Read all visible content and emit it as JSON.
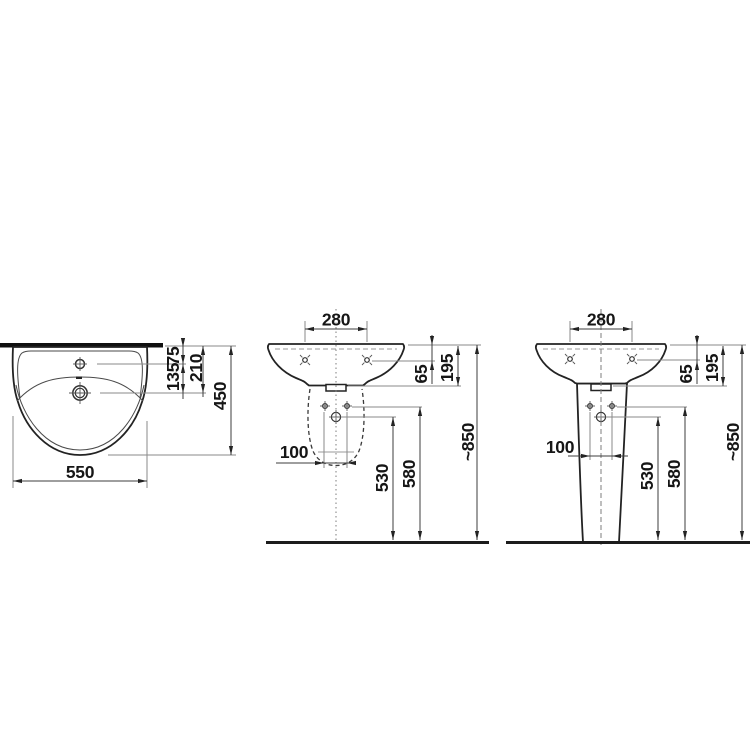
{
  "title": "Washbasin technical dimensional drawing",
  "colors": {
    "background": "#ffffff",
    "outline": "#232323",
    "dimension_line": "#3d3d3d",
    "leader_line": "#8a8a8a",
    "label_text": "#161616"
  },
  "views": {
    "top": {
      "label": "washbasin top view",
      "dims": {
        "width": "550",
        "depth": "450",
        "drain_to_wall": "210",
        "tap_to_drain": "135",
        "tap_to_wall": "75"
      }
    },
    "front_semi": {
      "label": "front view with semi-pedestal (hidden outline)",
      "dims": {
        "hole_spacing": "280",
        "rim_to_holes": "65",
        "rim_to_underside": "195",
        "pedestal_hole_spacing": "100",
        "trap_height": "530",
        "holes_height": "580",
        "overall_height": "~850"
      }
    },
    "front_ped": {
      "label": "front view with full pedestal",
      "dims": {
        "hole_spacing": "280",
        "rim_to_holes": "65",
        "rim_to_underside": "195",
        "pedestal_hole_spacing": "100",
        "trap_height": "530",
        "holes_height": "580",
        "overall_height": "~850"
      }
    }
  }
}
